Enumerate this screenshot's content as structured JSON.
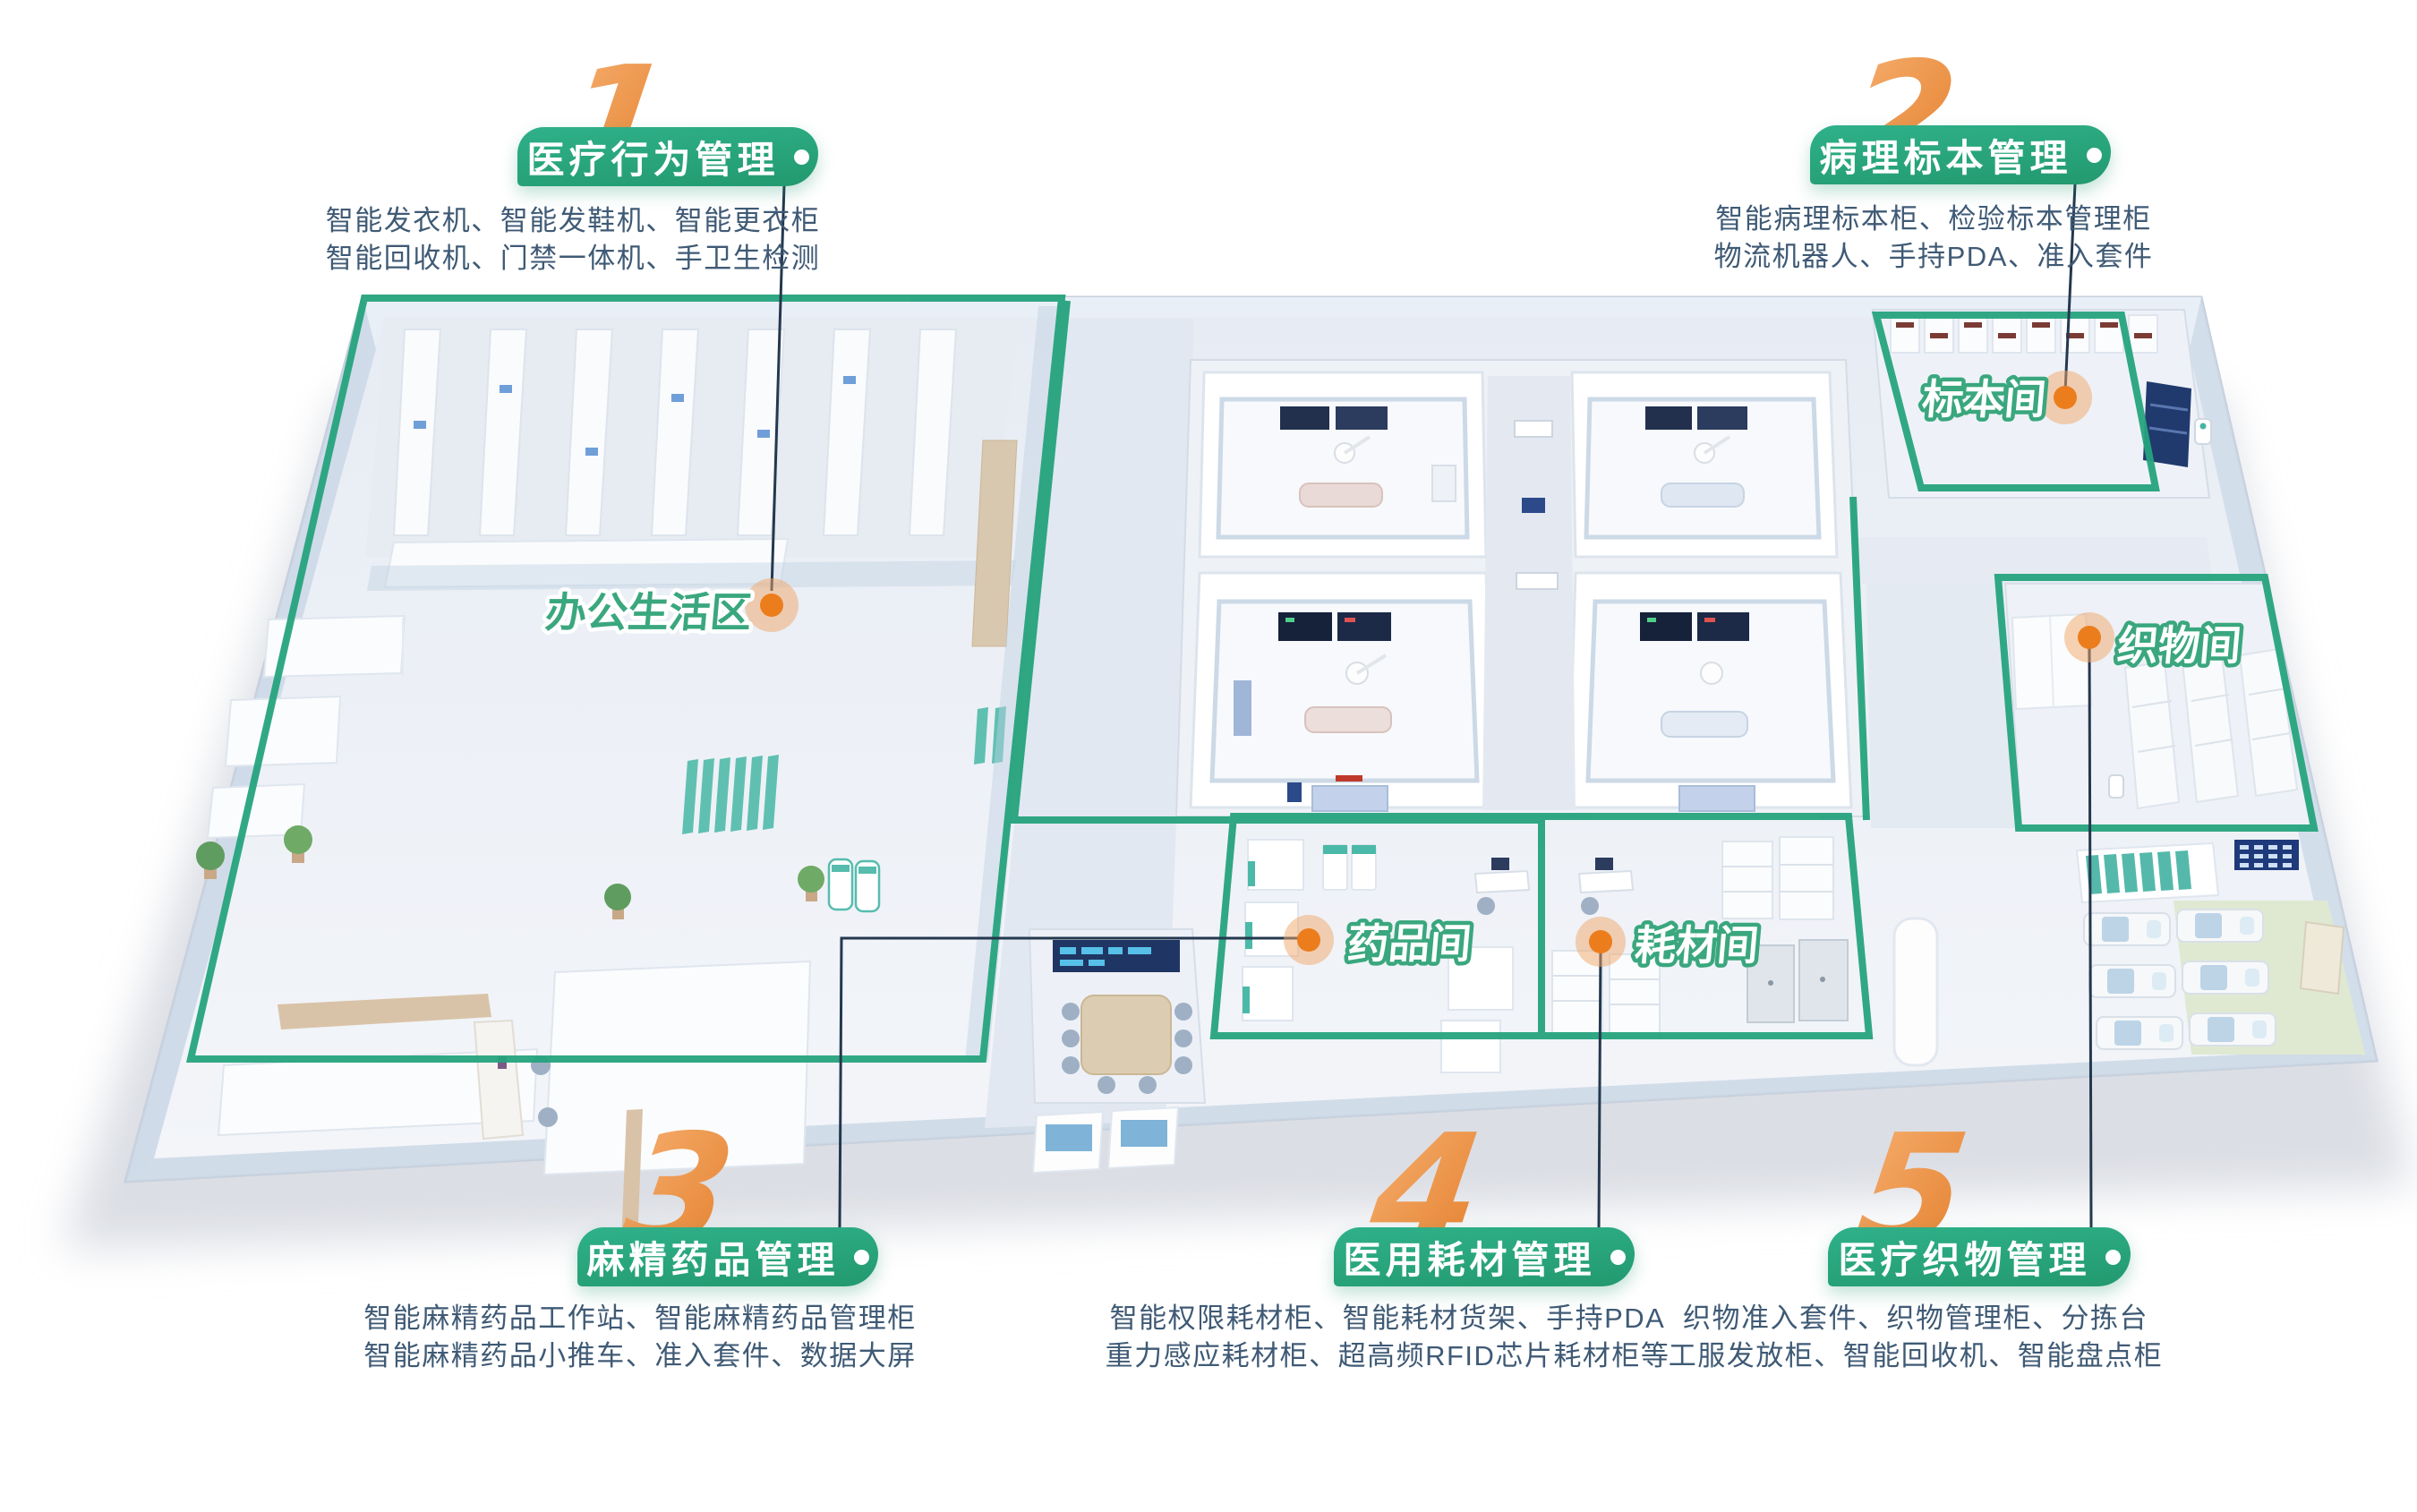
{
  "title": "智慧医院平面分区示意图",
  "colors": {
    "pill_teal": "#2aa57e",
    "numeral_orange": "#ed8b3e",
    "zone_outline_green": "#26a37d",
    "desc_text": "#3f5a75",
    "connector_line": "#24384e",
    "map_dot_orange": "#ec7d1d",
    "room_label_green": "#3aa77e",
    "floor_light": "#edf1f7",
    "bed_blanket_blue": "#bdd4e6",
    "ward_floor_green": "#dfe9d2",
    "navy_panel": "#1e3a7a"
  },
  "sections": [
    {
      "number": "1",
      "title": "医疗行为管理",
      "desc": [
        "智能发衣机、智能发鞋机、智能更衣柜",
        "智能回收机、门禁一体机、手卫生检测"
      ]
    },
    {
      "number": "2",
      "title": "病理标本管理",
      "desc": [
        "智能病理标本柜、检验标本管理柜",
        "物流机器人、手持PDA、准入套件"
      ]
    },
    {
      "number": "3",
      "title": "麻精药品管理",
      "desc": [
        "智能麻精药品工作站、智能麻精药品管理柜",
        "智能麻精药品小推车、准入套件、数据大屏"
      ]
    },
    {
      "number": "4",
      "title": "医用耗材管理",
      "desc": [
        "智能权限耗材柜、智能耗材货架、手持PDA",
        "重力感应耗材柜、超高频RFID芯片耗材柜等"
      ]
    },
    {
      "number": "5",
      "title": "医疗织物管理",
      "desc": [
        "织物准入套件、织物管理柜、分拣台",
        "工服发放柜、智能回收机、智能盘点柜"
      ]
    }
  ],
  "rooms": [
    {
      "label": "办公生活区"
    },
    {
      "label": "标本间"
    },
    {
      "label": "织物间"
    },
    {
      "label": "药品间"
    },
    {
      "label": "耗材间"
    }
  ]
}
